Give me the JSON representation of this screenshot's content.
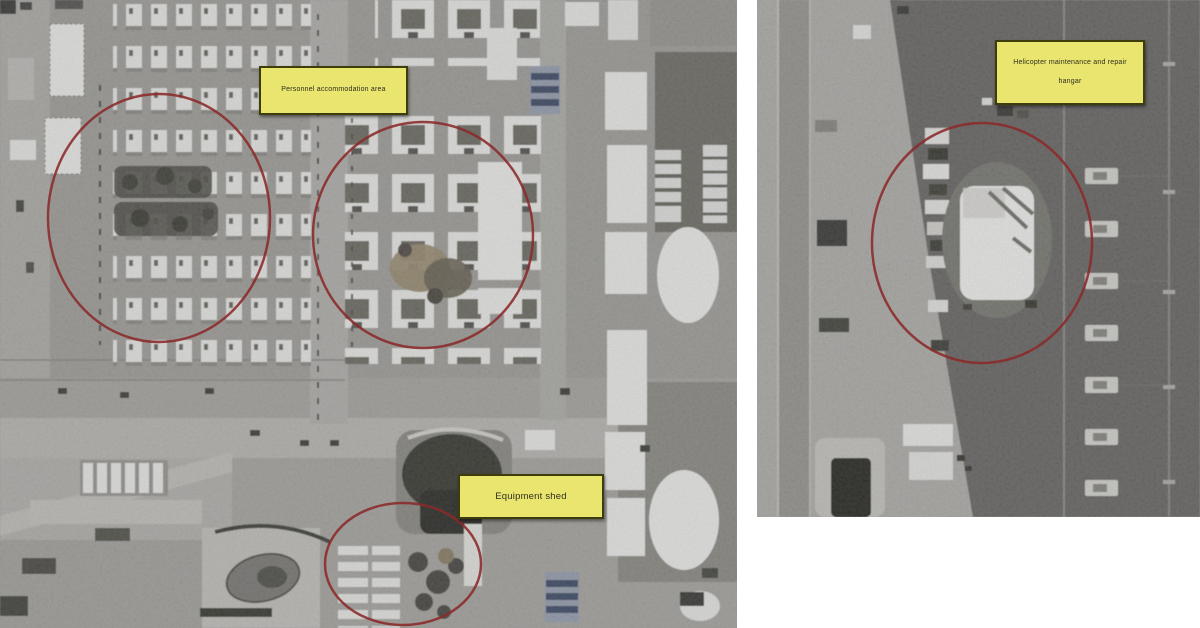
{
  "labels": {
    "personnel": {
      "text": "Personnel accommodation area"
    },
    "equipment": {
      "text": "Equipment shed"
    },
    "hangar": {
      "line1": "Helicopter maintenance and repair",
      "line2": "hangar"
    }
  },
  "colors": {
    "page_background": "#ffffff",
    "label_background": "#e9e56e",
    "label_border": "#3d3d0c",
    "label_text": "#2f2f1f",
    "annotation_red": "#8b2a2a"
  }
}
